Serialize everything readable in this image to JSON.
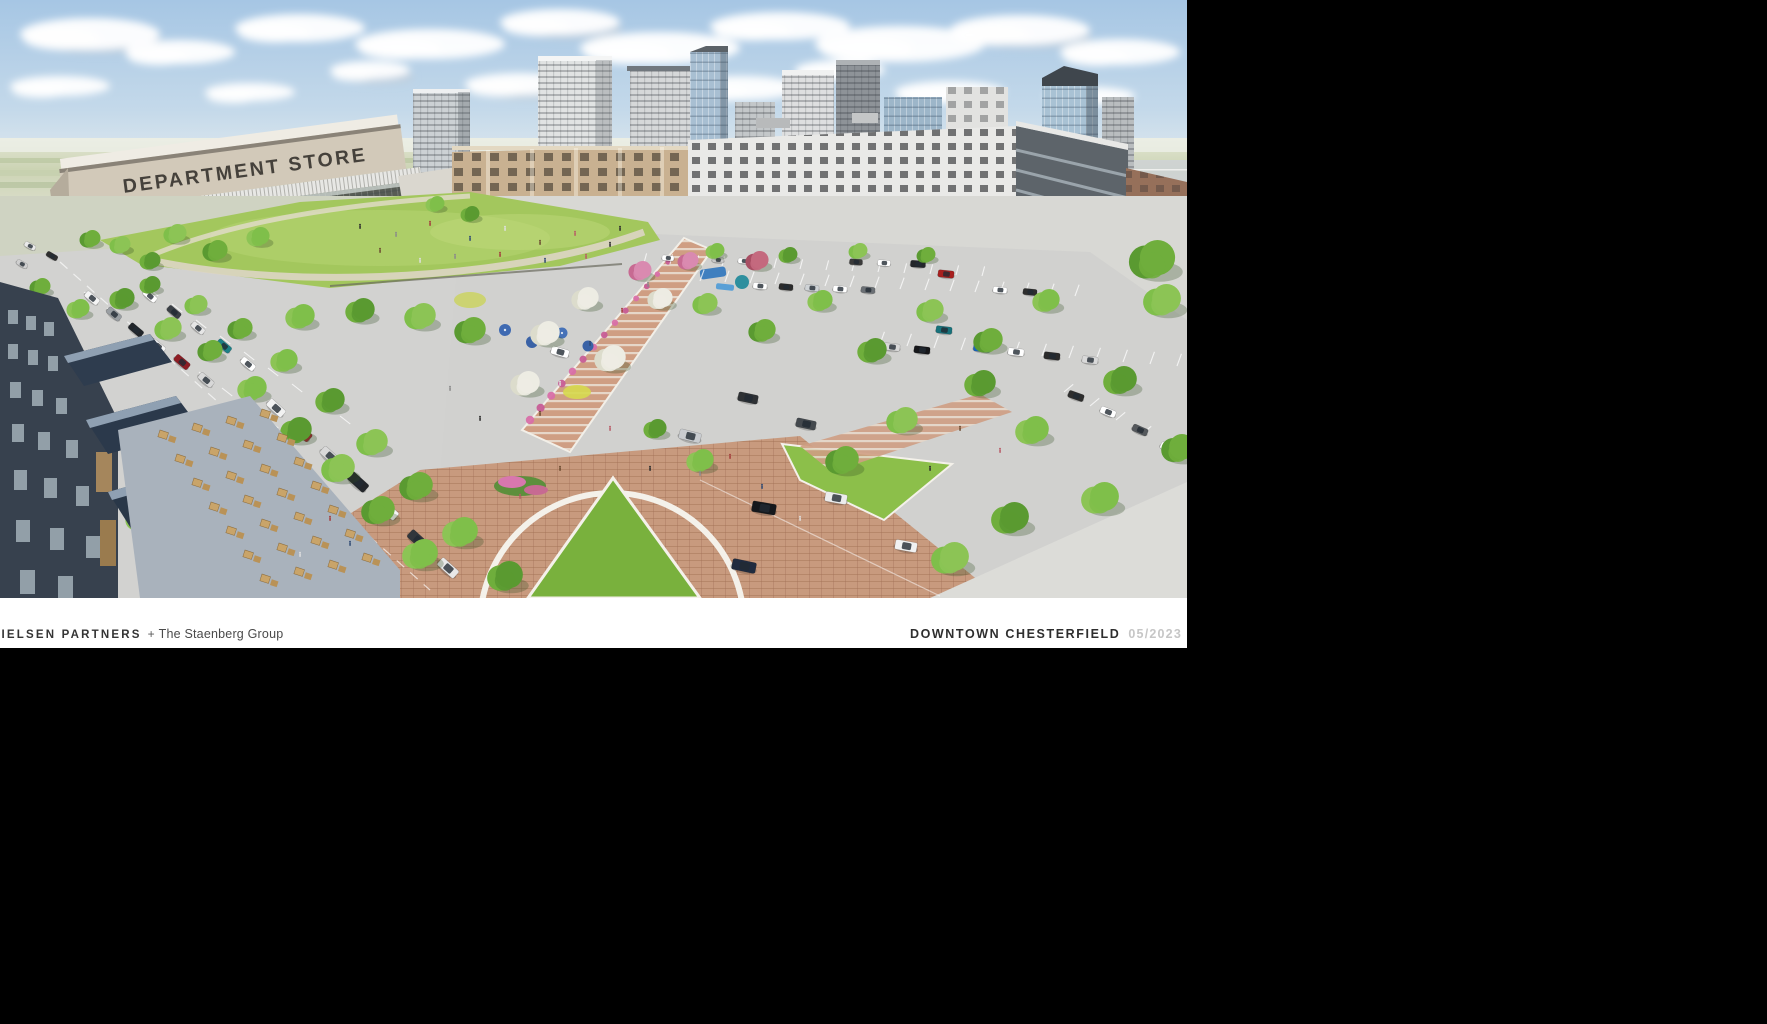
{
  "caption": {
    "left_bold": "NIELSEN PARTNERS",
    "left_plus": "+",
    "left_light": "The Staenberg Group",
    "right_bold": "DOWNTOWN CHESTERFIELD",
    "right_muted": "05/2023"
  },
  "scene": {
    "department_store_sign": "DEPARTMENT STORE",
    "storefront_signs": [
      "barbizon",
      "cycle",
      "ATLAS",
      "Valerie"
    ]
  },
  "palette": {
    "background": "#000000",
    "sky": "#aecbe6",
    "lawn": "#a3c75d",
    "plaza_brick": "#c89a7e",
    "caption_muted": "#c6c6c6"
  }
}
